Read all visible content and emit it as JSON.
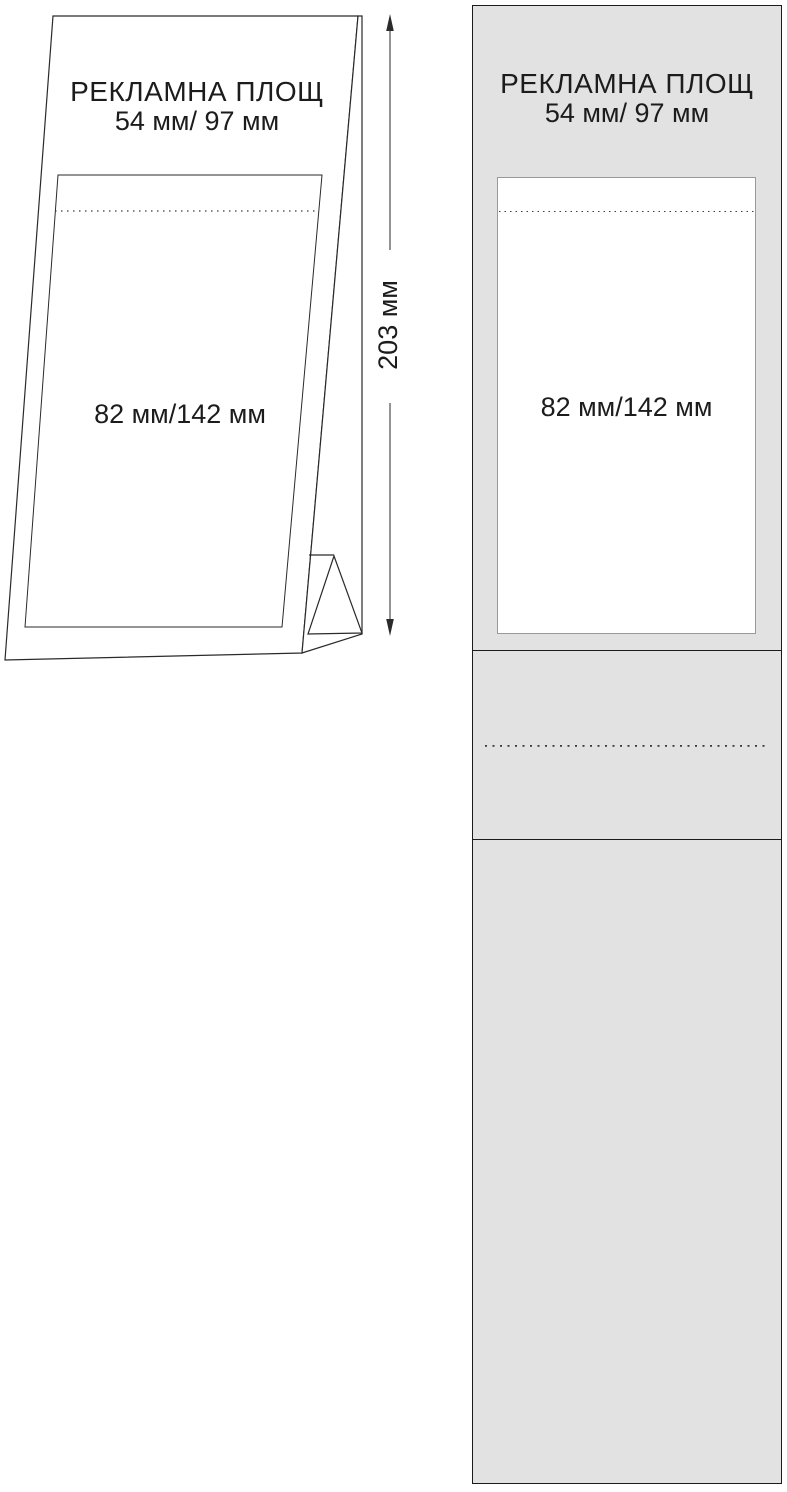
{
  "perspective_view": {
    "title": "РЕКЛАМНА ПЛОЩ",
    "size_label": "54 мм/ 97 мм",
    "area_label": "82 мм/142 мм",
    "height_label": "203 мм"
  },
  "flat_view": {
    "title": "РЕКЛАМНА ПЛОЩ",
    "size_label": "54 мм/ 97 мм",
    "area_label": "82 мм/142 мм"
  },
  "colors": {
    "panel_fill": "#e2e2e2",
    "line": "#2a2a2a",
    "ad_area_fill": "#ffffff",
    "ad_area_border": "#999999"
  }
}
